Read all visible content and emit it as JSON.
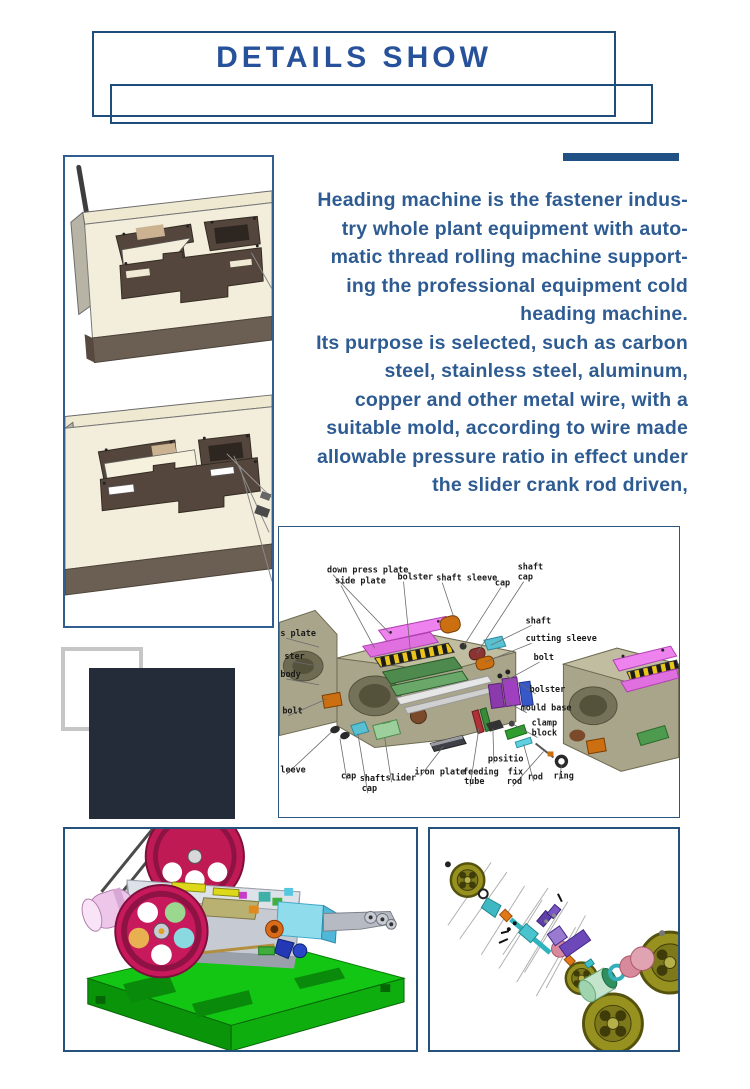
{
  "header": {
    "title": "DETAILS SHOW"
  },
  "colors": {
    "frame_blue": "#24527d",
    "header_box_blue": "#1f4e7c",
    "title_blue": "#27519a",
    "accent_bar_blue": "#215184",
    "paragraph_blue": "#2e5c92",
    "deco_gray": "#c6c6c6",
    "deco_navy": "#242c39"
  },
  "intro": {
    "lines": [
      "Heading machine is the fastener indus-",
      "try whole plant equipment with auto-",
      "matic thread rolling machine support-",
      "ing the professional equipment cold",
      "heading machine.",
      "Its purpose is selected, such as carbon",
      "steel, stainless steel, aluminum,",
      "copper and other metal wire, with a",
      "suitable mold, according to wire made",
      "allowable pressure ratio in effect under",
      "the slider crank rod driven,"
    ]
  },
  "diagram": {
    "labels": [
      {
        "t": "down press plate",
        "x": 48,
        "y": 46,
        "x2": 112,
        "y2": 108
      },
      {
        "t": "side plate",
        "x": 56,
        "y": 57,
        "x2": 96,
        "y2": 122
      },
      {
        "t": "bolster",
        "x": 119,
        "y": 53,
        "x2": 132,
        "y2": 126
      },
      {
        "t": "shaft sleeve",
        "x": 158,
        "y": 54,
        "x2": 176,
        "y2": 92
      },
      {
        "t": "cap",
        "x": 217,
        "y": 59,
        "x2": 186,
        "y2": 119
      },
      {
        "t": "shaft",
        "x": 240,
        "y": 43
      },
      {
        "t": "cap",
        "x": 240,
        "y": 53,
        "x2": 199,
        "y2": 127
      },
      {
        "t": "shaft",
        "x": 248,
        "y": 97,
        "x2": 213,
        "y2": 119
      },
      {
        "t": "cutting sleeve",
        "x": 248,
        "y": 115,
        "x2": 207,
        "y2": 136
      },
      {
        "t": "bolt",
        "x": 256,
        "y": 134,
        "x2": 222,
        "y2": 158
      },
      {
        "t": "s plate",
        "x": 1,
        "y": 110,
        "x2": 40,
        "y2": 121
      },
      {
        "t": "ster",
        "x": 5,
        "y": 133,
        "x2": 44,
        "y2": 141
      },
      {
        "t": "body",
        "x": 1,
        "y": 151,
        "x2": 40,
        "y2": 159
      },
      {
        "t": "bolt",
        "x": 3,
        "y": 188,
        "x2": 48,
        "y2": 173
      },
      {
        "t": "leeve",
        "x": 1,
        "y": 247,
        "x2": 52,
        "y2": 207
      },
      {
        "t": "cap",
        "x": 62,
        "y": 253,
        "x2": 61,
        "y2": 213
      },
      {
        "t": "shaft",
        "x": 81,
        "y": 256
      },
      {
        "t": "cap",
        "x": 83,
        "y": 266,
        "x2": 79,
        "y2": 208
      },
      {
        "t": "slider",
        "x": 107,
        "y": 255,
        "x2": 106,
        "y2": 212
      },
      {
        "t": "iron plate",
        "x": 136,
        "y": 249,
        "x2": 165,
        "y2": 221
      },
      {
        "t": "feeding",
        "x": 185,
        "y": 249
      },
      {
        "t": "tube",
        "x": 186,
        "y": 259,
        "x2": 201,
        "y2": 202
      },
      {
        "t": "positio",
        "x": 210,
        "y": 236,
        "x2": 215,
        "y2": 203
      },
      {
        "t": "fix",
        "x": 230,
        "y": 249
      },
      {
        "t": "rod",
        "x": 229,
        "y": 259,
        "x2": 266,
        "y2": 226
      },
      {
        "t": "rod",
        "x": 250,
        "y": 254,
        "x2": 246,
        "y2": 219
      },
      {
        "t": "ring",
        "x": 276,
        "y": 253,
        "x2": 284,
        "y2": 240
      },
      {
        "t": "bolster",
        "x": 252,
        "y": 166,
        "x2": 229,
        "y2": 150
      },
      {
        "t": "mould base",
        "x": 243,
        "y": 185,
        "x2": 225,
        "y2": 174
      },
      {
        "t": "clamp",
        "x": 254,
        "y": 200
      },
      {
        "t": "block",
        "x": 254,
        "y": 210,
        "x2": 236,
        "y2": 199
      }
    ]
  }
}
